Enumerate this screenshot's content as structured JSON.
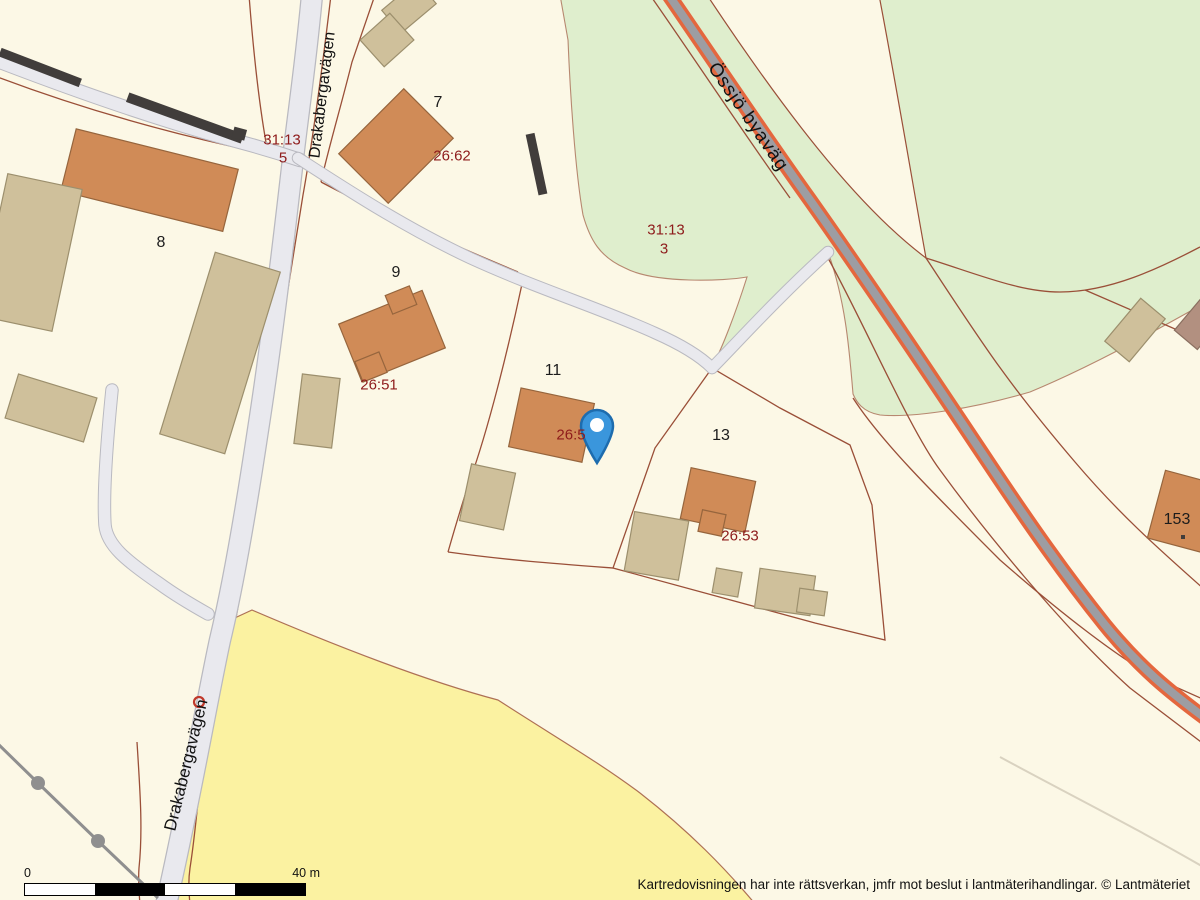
{
  "map": {
    "source": "cadastral-map",
    "attribution": "Kartredovisningen har inte rättsverkan, jmfr mot beslut i lantmäterihandlingar. © Lantmäteriet",
    "scale_bar": {
      "zero": "0",
      "max": "40 m"
    },
    "marker": {
      "kind": "location-pin",
      "fill": "#3a96dc",
      "stroke": "#1d6cae",
      "hole": "#ffffff"
    },
    "labels": {
      "roads": [
        {
          "text": "Drakabergavägen"
        },
        {
          "text": "Drakabergavägen"
        },
        {
          "text": "Össjö byaväg"
        }
      ],
      "parcels": [
        {
          "text": "31:13"
        },
        {
          "text": "5"
        },
        {
          "text": "26:62"
        },
        {
          "text": "31:13"
        },
        {
          "text": "3"
        },
        {
          "text": "26:51"
        },
        {
          "text": "26:5"
        },
        {
          "text": "26:53"
        }
      ],
      "houses": [
        {
          "text": "7"
        },
        {
          "text": "8"
        },
        {
          "text": "9"
        },
        {
          "text": "11"
        },
        {
          "text": "13"
        },
        {
          "text": "153"
        }
      ]
    },
    "colors": {
      "background": "#fcf8e6",
      "pasture_green": "#dfeecd",
      "field_yellow": "#fbf2a1",
      "minor_road_fill": "#e9e9ee",
      "minor_road_edge": "#b9b9c0",
      "major_road_core": "#9d9da2",
      "major_road_edge": "#e4673e",
      "parcel_line": "#9a4f38",
      "parcel_label_red": "#8e1b1b",
      "house_fill": "#d08b57",
      "house_stroke": "#96653d",
      "outbuilding_fill": "#cfc09b",
      "outbuilding_stroke": "#9c8f6d",
      "wall_dark": "#413d3b",
      "powerline_gray": "#8f8f8f"
    }
  }
}
